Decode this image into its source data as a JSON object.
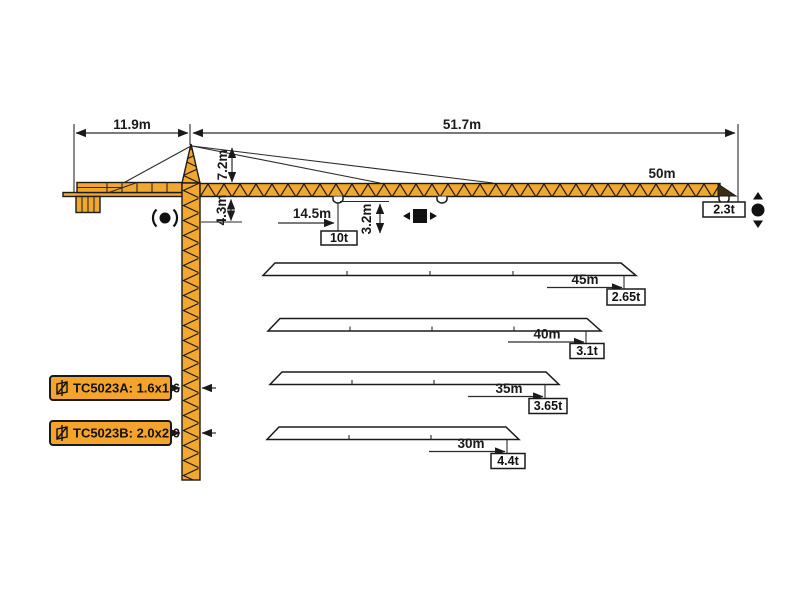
{
  "diagram_type": "tower-crane-load-diagram",
  "colors": {
    "crane_yellow": "#F2A72E",
    "outline_black": "#1A1A1A",
    "model_box_fill": "#F5A42B",
    "background": "#FFFFFF"
  },
  "dims": {
    "counter_jib_length": "11.9m",
    "jib_horizontal_span": "51.7m",
    "tower_head_height": "7.2m",
    "under_jib_clearance": "4.3m",
    "trolley_radius": "14.5m",
    "trolley_drop": "3.2m",
    "max_load": "10t",
    "main_jib_length": "50m",
    "main_tip_load": "2.3t"
  },
  "variants": [
    {
      "length": "45m",
      "tip_load": "2.65t"
    },
    {
      "length": "40m",
      "tip_load": "3.1t"
    },
    {
      "length": "35m",
      "tip_load": "3.65t"
    },
    {
      "length": "30m",
      "tip_load": "4.4t"
    }
  ],
  "models": [
    {
      "label": "TC5023A: 1.6x1.6"
    },
    {
      "label": "TC5023B: 2.0x2.0"
    }
  ],
  "chart_data": {
    "type": "table",
    "title": "TC5023 jib length vs tip load",
    "categories": [
      "50m",
      "45m",
      "40m",
      "35m",
      "30m"
    ],
    "values_tip_load_t": [
      2.3,
      2.65,
      3.1,
      3.65,
      4.4
    ],
    "max_load_t": 10,
    "max_load_radius_m": 14.5
  },
  "icons": {
    "slewing": "slewing-icon",
    "trolley_travel": "trolley-travel-icon",
    "hoisting": "hoisting-icon",
    "mast_section": "mast-section-icon"
  }
}
